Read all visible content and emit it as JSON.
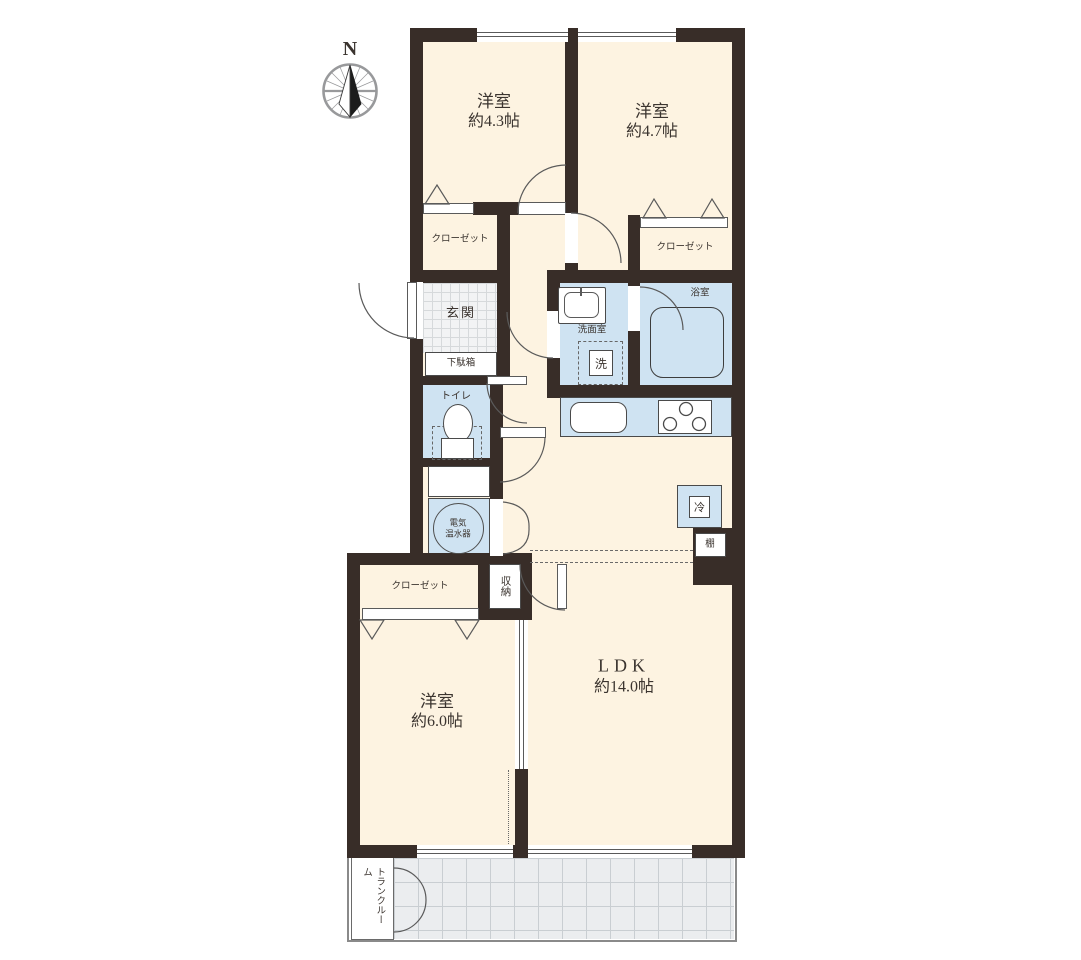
{
  "compass": {
    "north_label": "N"
  },
  "rooms": {
    "bedroom1": {
      "name": "洋室",
      "size": "約4.3帖"
    },
    "bedroom2": {
      "name": "洋室",
      "size": "約4.7帖"
    },
    "bedroom3": {
      "name": "洋室",
      "size": "約6.0帖"
    },
    "ldk": {
      "name": "LDK",
      "size": "約14.0帖"
    }
  },
  "features": {
    "closet": "クローゼット",
    "entrance": "玄関",
    "shoe_cabinet": "下駄箱",
    "toilet": "トイレ",
    "washroom": "洗面室",
    "bathroom": "浴室",
    "washer": "洗",
    "water_heater": {
      "line1": "電気",
      "line2": "温水器"
    },
    "refrigerator": "冷",
    "shelf": "棚",
    "storage": "収納",
    "trunk_room": {
      "line1": "トランク",
      "line2": "ルーム"
    }
  },
  "colors": {
    "wall": "#382d28",
    "floor": "#fdf3e1",
    "wet_area": "#cfe3f2",
    "entrance_tile": "#f2f3f4",
    "balcony_tile": "#ebedef"
  }
}
